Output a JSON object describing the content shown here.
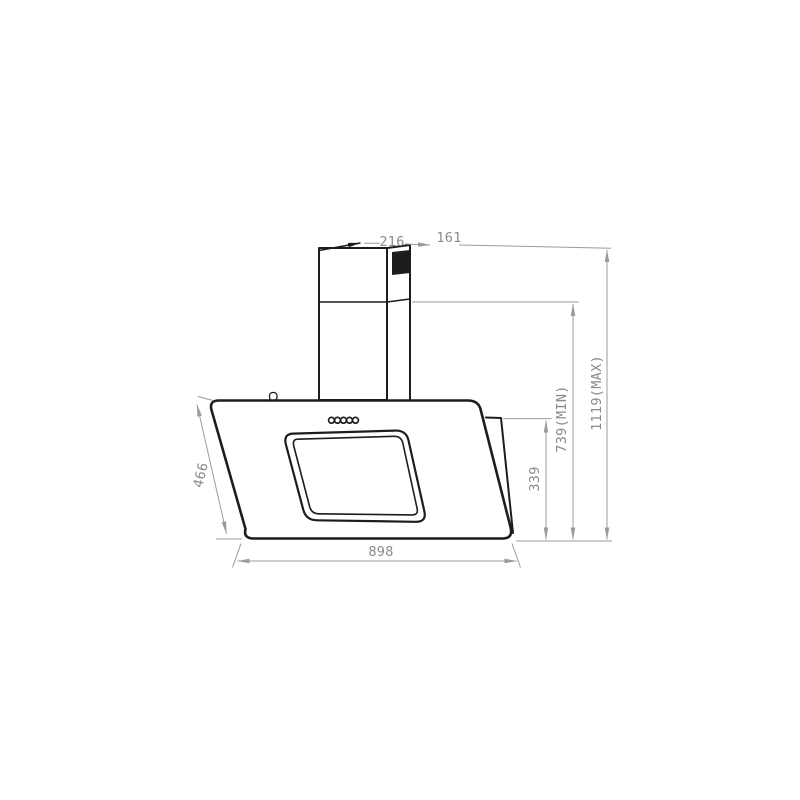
{
  "drawing": {
    "labels": {
      "top_depth": "216",
      "top_offset": "161",
      "panel_slant_height": "466",
      "body_width": "898",
      "lower_height": "339",
      "height_min": "739(MIN)",
      "height_max": "1119(MAX)"
    },
    "colors": {
      "background": "#ffffff",
      "object_line": "#1d1d1d",
      "dimension_line": "#9b9b9b",
      "dimension_text": "#8a8a8a",
      "outlet_fill": "#0a0a0a"
    }
  }
}
